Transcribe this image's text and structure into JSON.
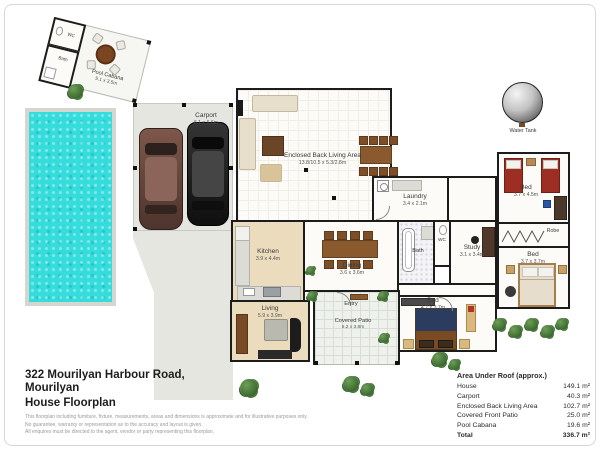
{
  "meta": {
    "address_line1": "322 Mourilyan Harbour Road,",
    "address_line2": "Mourilyan",
    "doc_type": "House Floorplan",
    "disclaimer_line1": "This floorplan including furniture, fixture, measurements, areas and dimensions is approximate and for illustrative purposes only.",
    "disclaimer_line2": "No guarantee, warranty or representation as to the accuracy and layout is given.",
    "disclaimer_line3": "All enquires must be directed to the agent, vendor or party representing this floorplan."
  },
  "area_table": {
    "title": "Area Under Roof (approx.)",
    "rows": [
      {
        "label": "House",
        "value": "149.1 m²"
      },
      {
        "label": "Carport",
        "value": "40.3 m²"
      },
      {
        "label": "Enclosed Back Living Area",
        "value": "102.7 m²"
      },
      {
        "label": "Covered Front Patio",
        "value": "25.0 m²"
      },
      {
        "label": "Pool Cabana",
        "value": "19.6 m²"
      }
    ],
    "total_label": "Total",
    "total_value": "336.7 m²"
  },
  "rooms": {
    "pool_cabana": {
      "name": "Pool Cabana",
      "dims": "5.1 x 3.5m"
    },
    "cabana_wc": {
      "name": "WC"
    },
    "cabana_bath": {
      "name": "Bath"
    },
    "carport": {
      "name": "Carport",
      "dims": "6.1 x 6.6m"
    },
    "back_living": {
      "name": "Enclosed Back Living Area",
      "dims": "13.8/10.5 x 5.3/2.8m"
    },
    "laundry": {
      "name": "Laundry",
      "dims": "3.4 x 2.1m"
    },
    "kitchen": {
      "name": "Kitchen",
      "dims": "3.9 x 4.4m"
    },
    "dining": {
      "name": "Dining",
      "dims": "3.6 x 3.6m"
    },
    "bath": {
      "name": "Bath"
    },
    "wc": {
      "name": "WC"
    },
    "study": {
      "name": "Study",
      "dims": "3.1 x 3.4m"
    },
    "bed1": {
      "name": "Bed",
      "dims": "3.7 x 4.5m"
    },
    "robe": {
      "name": "Robe"
    },
    "bed2": {
      "name": "Bed",
      "dims": "3.7 x 3.7m"
    },
    "bed3": {
      "name": "Bed",
      "dims": "4.7 x 3.7m"
    },
    "living": {
      "name": "Living",
      "dims": "5.9 x 3.9m"
    },
    "entry": {
      "name": "Entry"
    },
    "patio": {
      "name": "Covered Patio",
      "dims": "5.2 x 3.8m"
    }
  },
  "labels": {
    "water_tank": "Water Tank"
  },
  "colors": {
    "pool_water": "#35dcdc",
    "wall": "#1c1c1c",
    "driveway": "#e6e6e1",
    "floor_tan": "#ecdcbe",
    "bed_red": "#9c2e24",
    "tree_green": "#3f6d34"
  }
}
